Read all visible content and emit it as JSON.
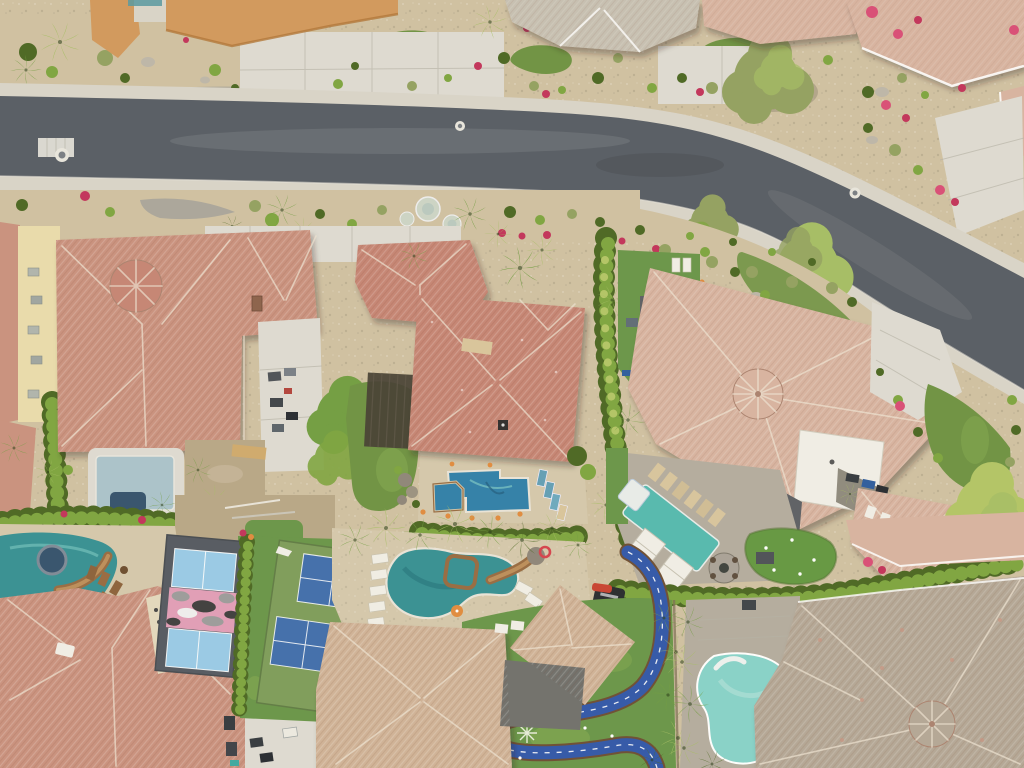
{
  "meta": {
    "title": "Top-down aerial drone photo of an upscale desert residential neighborhood",
    "description": "Overhead view of a curving asphalt street lined with tile-roof homes, xeriscaped yards, palm trees, backyard pools, pickleball courts, a go-kart track and putting greens",
    "setting": "desert suburb at dusk",
    "view": "orthographic top-down"
  },
  "palette": {
    "roadAsphalt": "#545a62",
    "roadWorn": "#767c82",
    "roadDark": "#40464d",
    "sidewalk": "#d8d4c9",
    "concrete": "#cfccc2",
    "concreteLight": "#dedbd2",
    "seam": "#b4b1a6",
    "desertSand": "#cfc0a1",
    "desertDirt": "#b7a685",
    "gravelGray": "#a9a59a",
    "boulder": "#bcb6a8",
    "lawn": "#6c9140",
    "lawnDark": "#4f7030",
    "lawnBright": "#83aa4e",
    "turf": "#679446",
    "puttingGreen": "#61963f",
    "hedgeDark": "#48651f",
    "hedgeBright": "#7ca43d",
    "hedgeYellow": "#b2c464",
    "palmGreen": "#6f9c3f",
    "palmLight": "#a4bd62",
    "treeOlive": "#91a05e",
    "roofSalmon": "#c9907d",
    "roofRed": "#c58372",
    "roofPink": "#d7b3a0",
    "roofTan": "#cfb296",
    "roofGray": "#c6bfb1",
    "roofGrayBrown": "#b3a695",
    "roofCharcoal": "#5a5d62",
    "ridgeLight": "#eee3d2",
    "roofEdge": "#a9806d",
    "orangeWall": "#d1975a",
    "creamWall": "#e9dcab",
    "white": "#f1efe7",
    "poolTeal": "#338f92",
    "poolTealDeep": "#1f7076",
    "poolBlue": "#2d7ea8",
    "poolAqua": "#85d2c9",
    "poolCover": "#52b9ae",
    "poolPale": "#a9c2cb",
    "spaDark": "#31506b",
    "courtGray": "#52575f",
    "courtLightBlue": "#97cae7",
    "courtGreen": "#7c9b58",
    "courtBlue": "#3e6cab",
    "camoPink": "#e19cb7",
    "camoGray": "#9a9a9a",
    "camoDark": "#3c3c3c",
    "trackBlue": "#2e55a8",
    "trackEdge": "#6b4b30",
    "deckTan": "#d4c8ab",
    "paverGray": "#b3ab9d",
    "stoneBrown": "#96693f",
    "stoneLight": "#bb8d58",
    "flowerRed": "#c13058",
    "flowerMagenta": "#d84a74",
    "orangeAccent": "#e08a3c",
    "cartDark": "#31363c",
    "carWhite": "#eceae2",
    "carBlue": "#2a5a9c",
    "kartRed": "#c8402e"
  },
  "road": {
    "surface": "asphalt",
    "shape": "gentle S-curve from left edge to lower right",
    "manhole_count": 3,
    "sidewalks": "concrete on both sides",
    "utility_patch": "white grid near left curb"
  },
  "north_block": {
    "houses": [
      {
        "id": "top-left-building",
        "roof": "orange flat parapet"
      },
      {
        "id": "top-center-house",
        "roof": "gray tile hip with white gables"
      },
      {
        "id": "top-right-house",
        "roof": "pink tile"
      },
      {
        "id": "corner-house",
        "roof": "pink tile with white trim and driveway to the curve"
      }
    ],
    "yard": "desert gravel with kidney-shaped lawns, palms, shrub balls and red bougainvillea",
    "driveways": 3
  },
  "middle_block": {
    "houses": [
      {
        "id": "mid-left-house",
        "roof": "salmon tile with octagonal cupola",
        "yard": "construction concrete pad, dirt, small pale pool"
      },
      {
        "id": "center-house",
        "roof": "red-salmon tile",
        "yard": "blue pool with spa, teal loungers, tiki torches"
      },
      {
        "id": "right-house",
        "roof": "pale pink tile with round turret and white flat wing",
        "yard": "turf, covered teal lap pool, white spa, tan loungers, two white cabanas, stone fire pit, putting green"
      }
    ],
    "hedge_walls": "tall sculpted hedges between properties"
  },
  "south_block": {
    "houses": [
      {
        "id": "bottom-left-house",
        "roof": "salmon tile with pointed gable"
      },
      {
        "id": "bottom-center-house",
        "roof": "tan tile, resort backyard"
      },
      {
        "id": "bottom-right-house",
        "roof": "gray-tan tile with round turret"
      }
    ],
    "amenities": [
      "lazy-river pool with rock waterslide and round spa",
      "blue-striped loungers",
      "golf-cart parking court",
      "resort pool with rock slide and white loungers",
      "orange umbrella",
      "blue go-kart track with white dashed centerline",
      "putting greens with flags",
      "light turquoise lagoon pool"
    ]
  },
  "courts": [
    {
      "name": "camo-pickleball-court",
      "surface_color": "dark gray",
      "court_color": "light blue",
      "band": "pink-gray-black camouflage stripe across the middle"
    },
    {
      "name": "twin-pickleball-court",
      "surface_color": "olive green",
      "court_color": "royal blue",
      "count": 2
    }
  ],
  "track": {
    "type": "backyard go-kart track",
    "color": "blue",
    "centerline": "white dashed",
    "edge": "brown",
    "kart_color": "red"
  },
  "pools": [
    {
      "name": "lazy-river-pool",
      "color": "deep teal"
    },
    {
      "name": "construction-pool",
      "color": "pale gray-blue"
    },
    {
      "name": "center-backyard-pool",
      "color": "deep blue with attached spa"
    },
    {
      "name": "covered-lap-pool",
      "color": "bright teal with white spa"
    },
    {
      "name": "resort-pool",
      "color": "green-teal freeform"
    },
    {
      "name": "lagoon-pool",
      "color": "light turquoise"
    }
  ],
  "vehicles": {
    "golf_carts": 5,
    "white_cart": 1,
    "red_gokart": 1,
    "driveway_cars": 3
  },
  "vegetation": {
    "palms": "40+ fan palms",
    "hedges": "dense trimmed privacy hedges",
    "flowers": "magenta bougainvillea and red shrubs",
    "special": "yellow-green feathery palo verde tree"
  }
}
